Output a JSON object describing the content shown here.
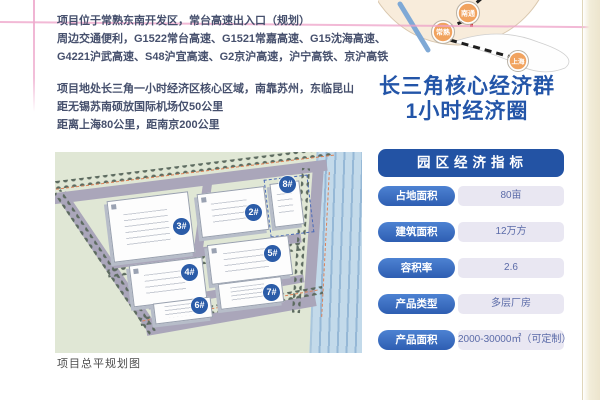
{
  "intro": {
    "location": {
      "line1": "项目位于常熟东南开发区，常台高速出入口（规划）",
      "line2": "周边交通便利，G1522常台高速、G1521常嘉高速、G15沈海高速、",
      "line3": "G4221沪武高速、S48沪宜高速、G2京沪高速，沪宁高铁、京沪高铁"
    },
    "distance": {
      "line1": "项目地处长三角一小时经济区核心区域，南靠苏州，东临昆山",
      "line2": "距无锡苏南硕放国际机场仅50公里",
      "line3": "距离上海80公里，距南京200公里"
    }
  },
  "headline": {
    "line1": "长三角核心经济群",
    "line2": "1小时经济圈"
  },
  "map": {
    "cities": [
      {
        "name": "南通"
      },
      {
        "name": "常熟"
      },
      {
        "name": "上海"
      }
    ]
  },
  "indicators": {
    "title": "园区经济指标",
    "rows": [
      {
        "label": "占地面积",
        "value": "80亩"
      },
      {
        "label": "建筑面积",
        "value": "12万方"
      },
      {
        "label": "容积率",
        "value": "2.6"
      },
      {
        "label": "产品类型",
        "value": "多层厂房"
      },
      {
        "label": "产品面积",
        "value": "2000-30000㎡（可定制）"
      }
    ]
  },
  "plan": {
    "caption": "项目总平规划图",
    "buildings": [
      {
        "label": "2#"
      },
      {
        "label": "3#"
      },
      {
        "label": "4#"
      },
      {
        "label": "5#"
      },
      {
        "label": "6#"
      },
      {
        "label": "7#"
      },
      {
        "label": "8#"
      }
    ]
  },
  "colors": {
    "accent_blue": "#2355A8",
    "table_header_blue": "#2353A4",
    "pill_blue": "#3A6CC0",
    "value_pill_bg": "#E9E7F2",
    "marker_orange": "#F1A35F",
    "rule_pink": "#EEA2C8",
    "plan_green": "#E0E7D5",
    "river_blue": "#C3DAEA"
  }
}
